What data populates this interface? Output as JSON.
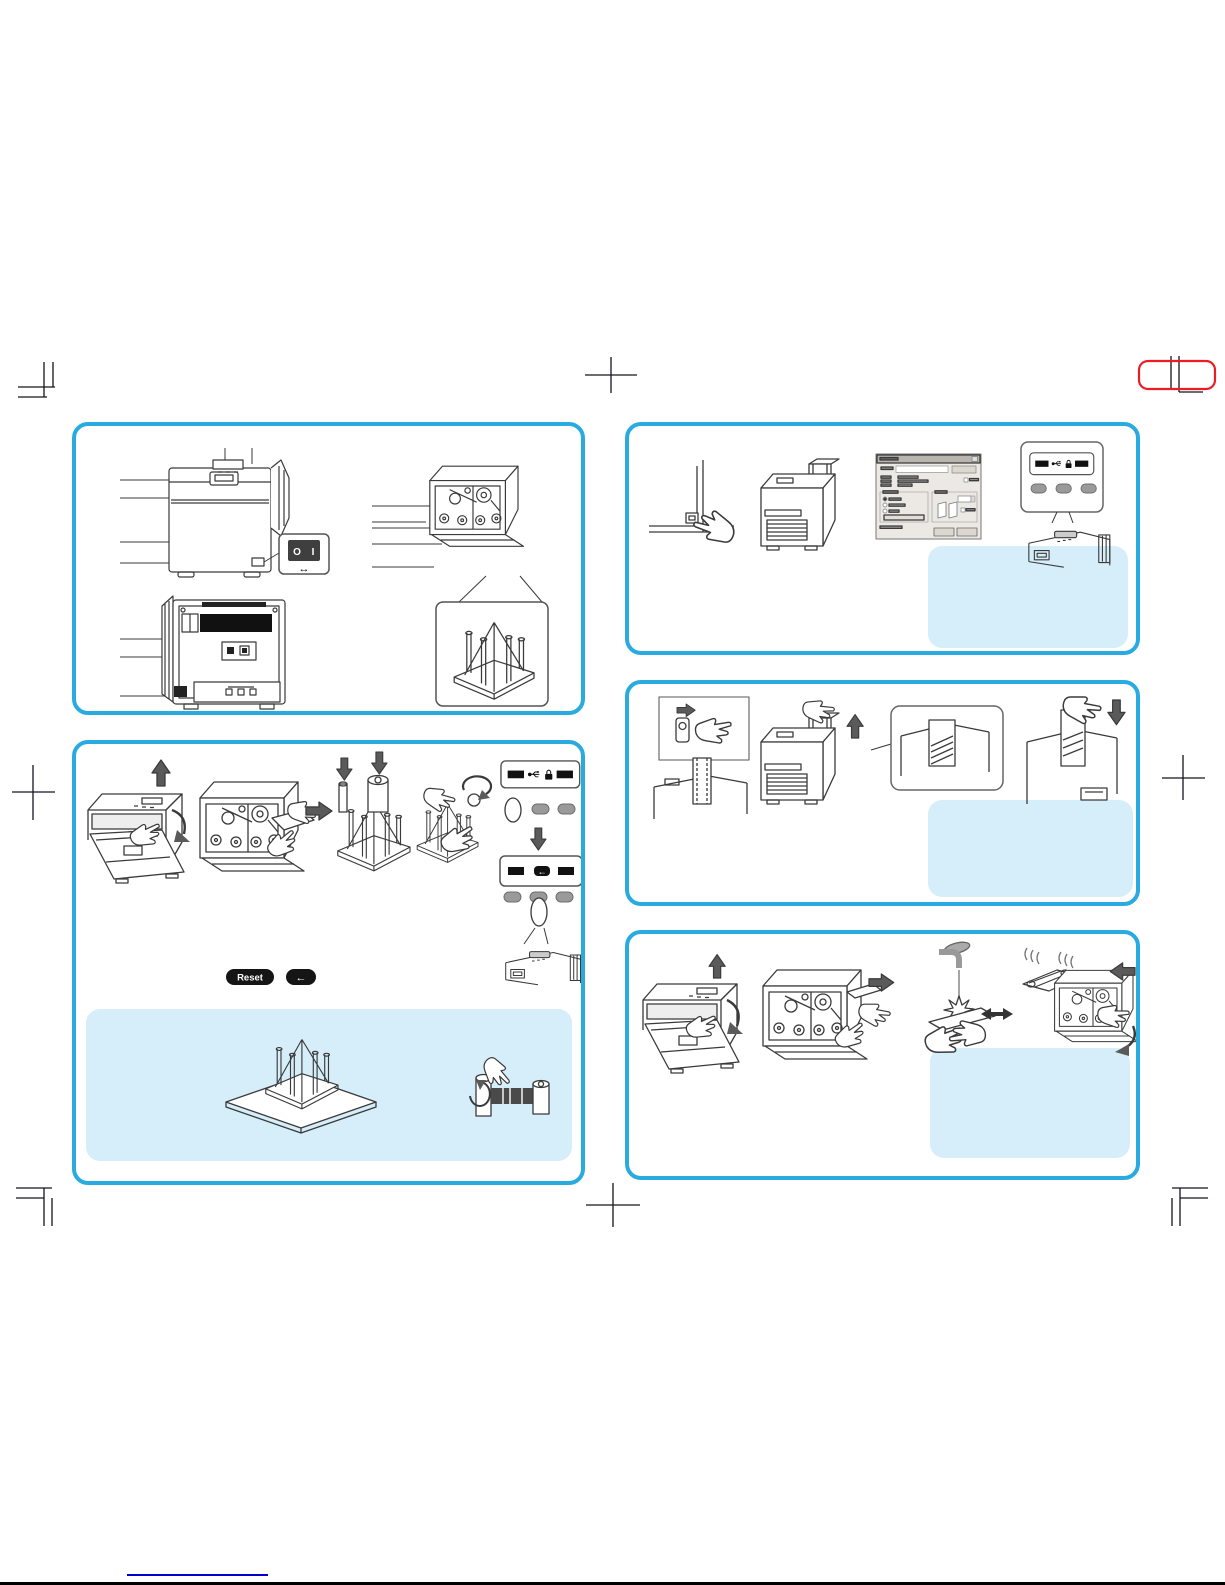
{
  "page": {
    "width": 1225,
    "height": 1585
  },
  "colors": {
    "panel_border": "#29ABE2",
    "note_box_fill": "#D6EEF9",
    "registration_mark_red": "#ED1C24",
    "footer_link_blue": "#0000CC",
    "line_art_ink": "#3A3A3A",
    "panel_button_gray": "#9A9A9A"
  },
  "icons": {
    "display_status": "status-bar-icon",
    "usb": "usb-icon",
    "lock": "lock-icon",
    "enter": "enter-arrow-icon",
    "power": "power-rocker-icon"
  },
  "labels": {
    "reset_badge": "Reset",
    "enter_badge": "←",
    "display2_enter": "←",
    "power_switch_off": "O",
    "power_switch_on": "I",
    "power_switch_arrow": "↔"
  }
}
